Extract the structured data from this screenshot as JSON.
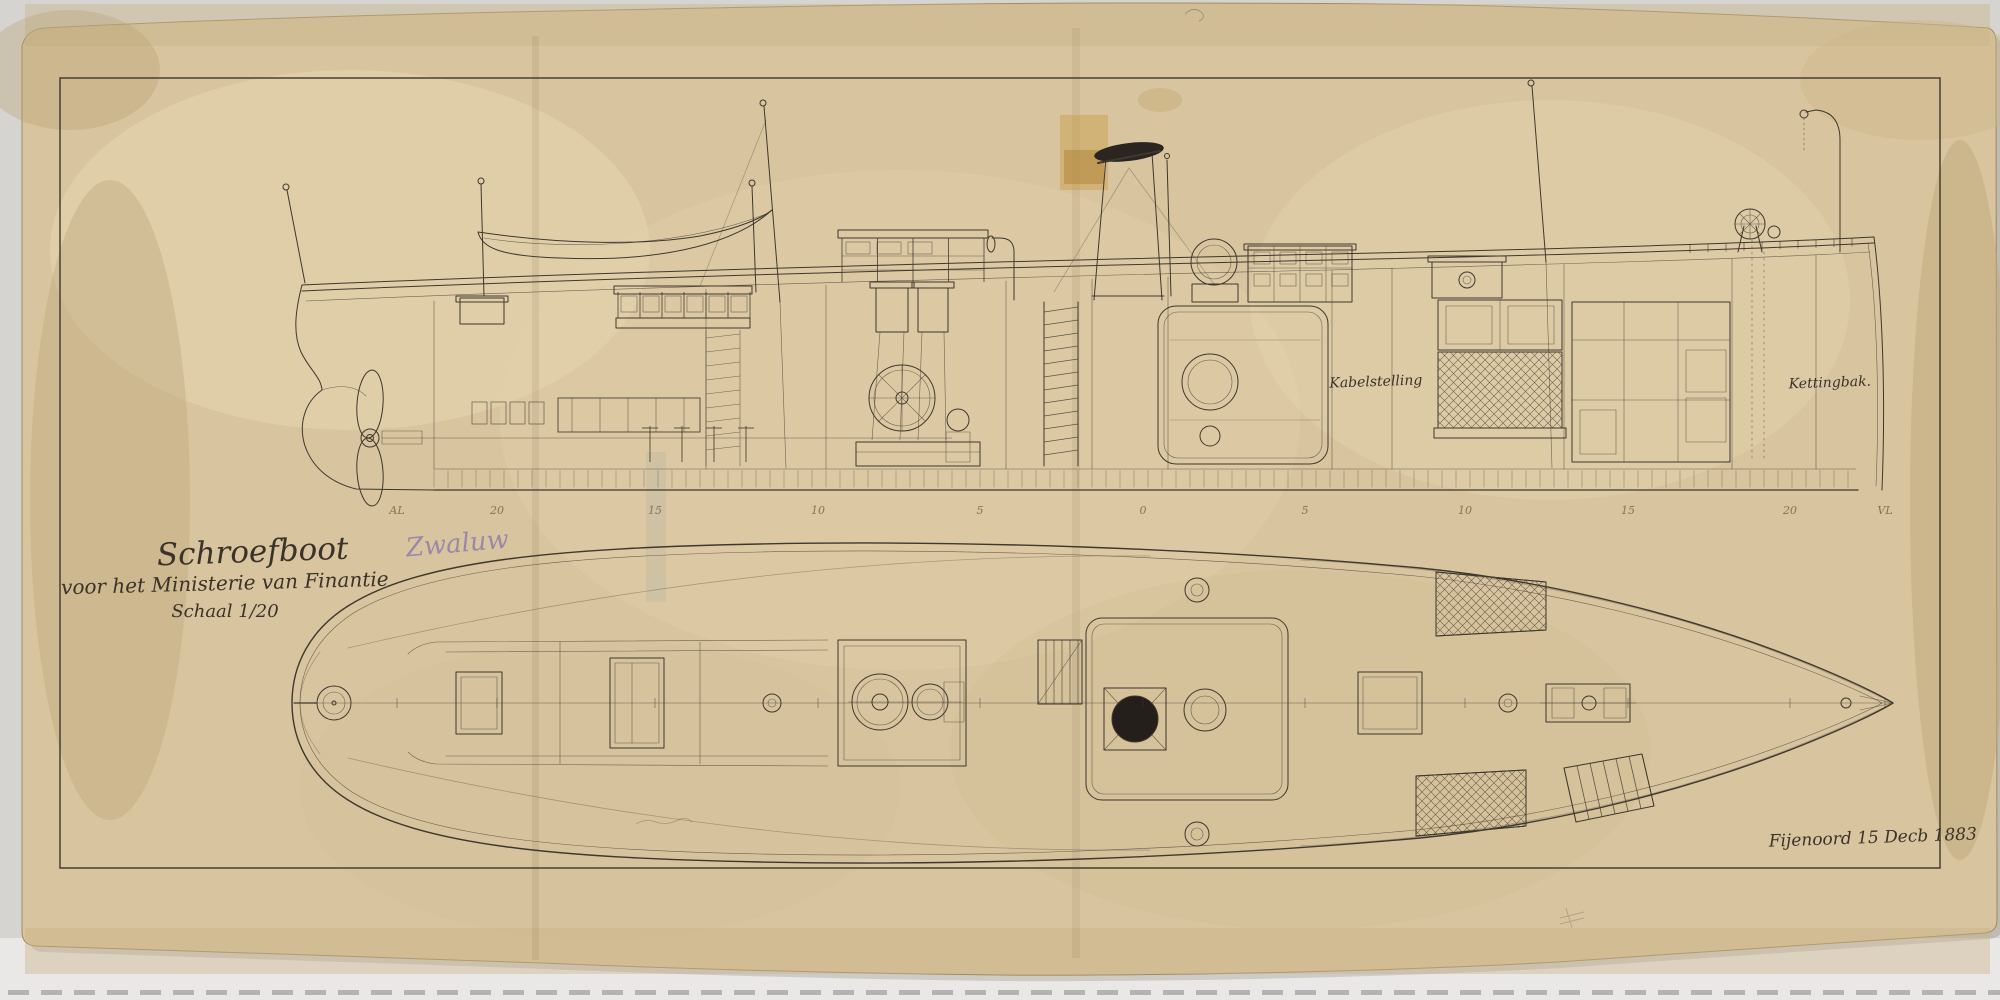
{
  "document": {
    "kind": "ship-construction-drawing",
    "title": "Schroefboot",
    "vessel_name": "Zwaluw",
    "subtitle": "voor het Ministerie van Finantie",
    "scale": "Schaal 1/20",
    "signature": "Fijenoord 15 Decb 1883",
    "labels": {
      "crew_space": "Kabelstelling",
      "chain_locker": "Kettingbak."
    },
    "stations": [
      {
        "t": "AL",
        "x": 397
      },
      {
        "t": "20",
        "x": 497
      },
      {
        "t": "15",
        "x": 655
      },
      {
        "t": "10",
        "x": 818
      },
      {
        "t": "5",
        "x": 980
      },
      {
        "t": "0",
        "x": 1143
      },
      {
        "t": "5",
        "x": 1305
      },
      {
        "t": "10",
        "x": 1465
      },
      {
        "t": "15",
        "x": 1628
      },
      {
        "t": "20",
        "x": 1790
      },
      {
        "t": "VL",
        "x": 1885
      }
    ],
    "colors": {
      "paper": "#d8c49e",
      "paper_edge": "#a08a5f",
      "ink": "#3f382e",
      "pencil": "#8d7aa8",
      "margin": "#d7d5d2",
      "bottom_margin": "#e9e8e6",
      "dash": "#a9a9a9",
      "funnel_black": "#2a2521"
    }
  }
}
